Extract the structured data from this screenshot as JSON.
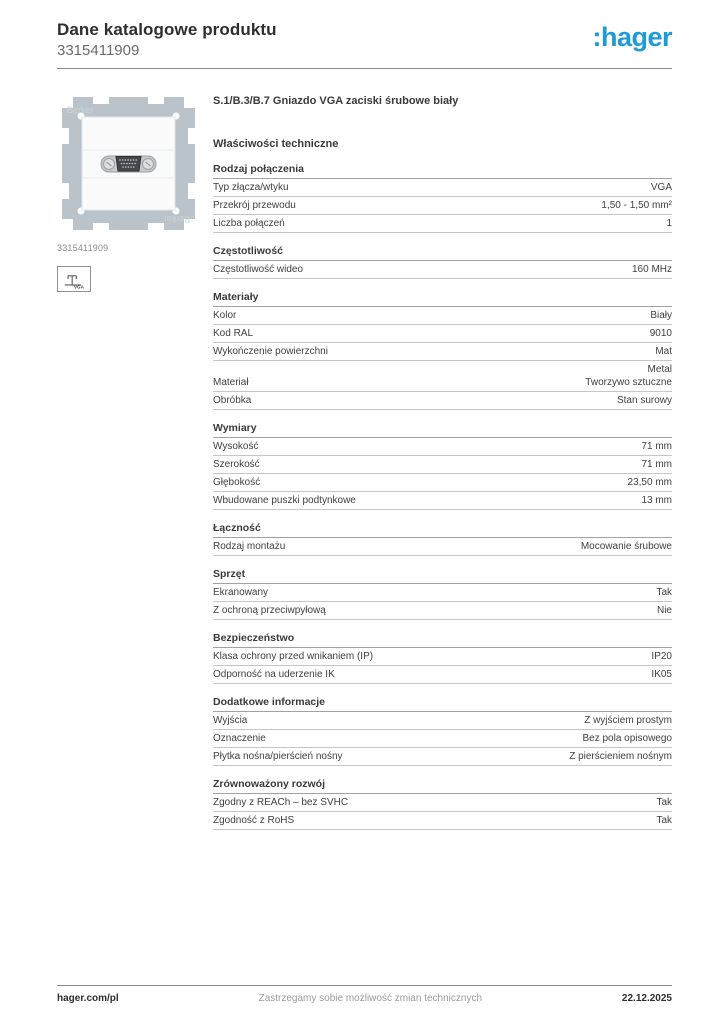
{
  "header": {
    "title": "Dane katalogowe produktu",
    "product_number": "3315411909",
    "logo_text": ":hager",
    "brand_color": "#1d9bd5"
  },
  "product": {
    "name": "S.1/B.3/B.7 Gniazdo VGA zaciski śrubowe biały",
    "image_caption": "3315411909",
    "image_watermark": "Berker",
    "icon_label": "VGA"
  },
  "section_title": "Właściwości techniczne",
  "sections": [
    {
      "title": "Rodzaj połączenia",
      "rows": [
        {
          "label": "Typ złącza/wtyku",
          "value": "VGA"
        },
        {
          "label": "Przekrój przewodu",
          "value": "1,50 - 1,50 mm²"
        },
        {
          "label": "Liczba połączeń",
          "value": "1"
        }
      ]
    },
    {
      "title": "Częstotliwość",
      "rows": [
        {
          "label": "Częstotliwość wideo",
          "value": "160 MHz"
        }
      ]
    },
    {
      "title": "Materiały",
      "rows": [
        {
          "label": "Kolor",
          "value": "Biały"
        },
        {
          "label": "Kod RAL",
          "value": "9010"
        },
        {
          "label": "Wykończenie powierzchni",
          "value": "Mat"
        },
        {
          "label": "Materiał",
          "value": [
            "Metal",
            "Tworzywo sztuczne"
          ]
        },
        {
          "label": "Obróbka",
          "value": "Stan surowy"
        }
      ]
    },
    {
      "title": "Wymiary",
      "rows": [
        {
          "label": "Wysokość",
          "value": "71 mm"
        },
        {
          "label": "Szerokość",
          "value": "71 mm"
        },
        {
          "label": "Głębokość",
          "value": "23,50 mm"
        },
        {
          "label": "Wbudowane puszki podtynkowe",
          "value": "13 mm"
        }
      ]
    },
    {
      "title": "Łączność",
      "rows": [
        {
          "label": "Rodzaj montażu",
          "value": "Mocowanie śrubowe"
        }
      ]
    },
    {
      "title": "Sprzęt",
      "rows": [
        {
          "label": "Ekranowany",
          "value": "Tak"
        },
        {
          "label": "Z ochroną przeciwpyłową",
          "value": "Nie"
        }
      ]
    },
    {
      "title": "Bezpieczeństwo",
      "rows": [
        {
          "label": "Klasa ochrony przed wnikaniem (IP)",
          "value": "IP20"
        },
        {
          "label": "Odporność na uderzenie IK",
          "value": "IK05"
        }
      ]
    },
    {
      "title": "Dodatkowe informacje",
      "rows": [
        {
          "label": "Wyjścia",
          "value": "Z wyjściem prostym"
        },
        {
          "label": "Oznaczenie",
          "value": "Bez pola opisowego"
        },
        {
          "label": "Płytka nośna/pierścień nośny",
          "value": "Z pierścieniem nośnym"
        }
      ]
    },
    {
      "title": "Zrównoważony rozwój",
      "rows": [
        {
          "label": "Zgodny z REACh – bez SVHC",
          "value": "Tak"
        },
        {
          "label": "Zgodność z RoHS",
          "value": "Tak"
        }
      ]
    }
  ],
  "footer": {
    "left": "hager.com/pl",
    "center": "Zastrzegamy sobie możliwość zmian technicznych",
    "right": "22.12.2025"
  }
}
